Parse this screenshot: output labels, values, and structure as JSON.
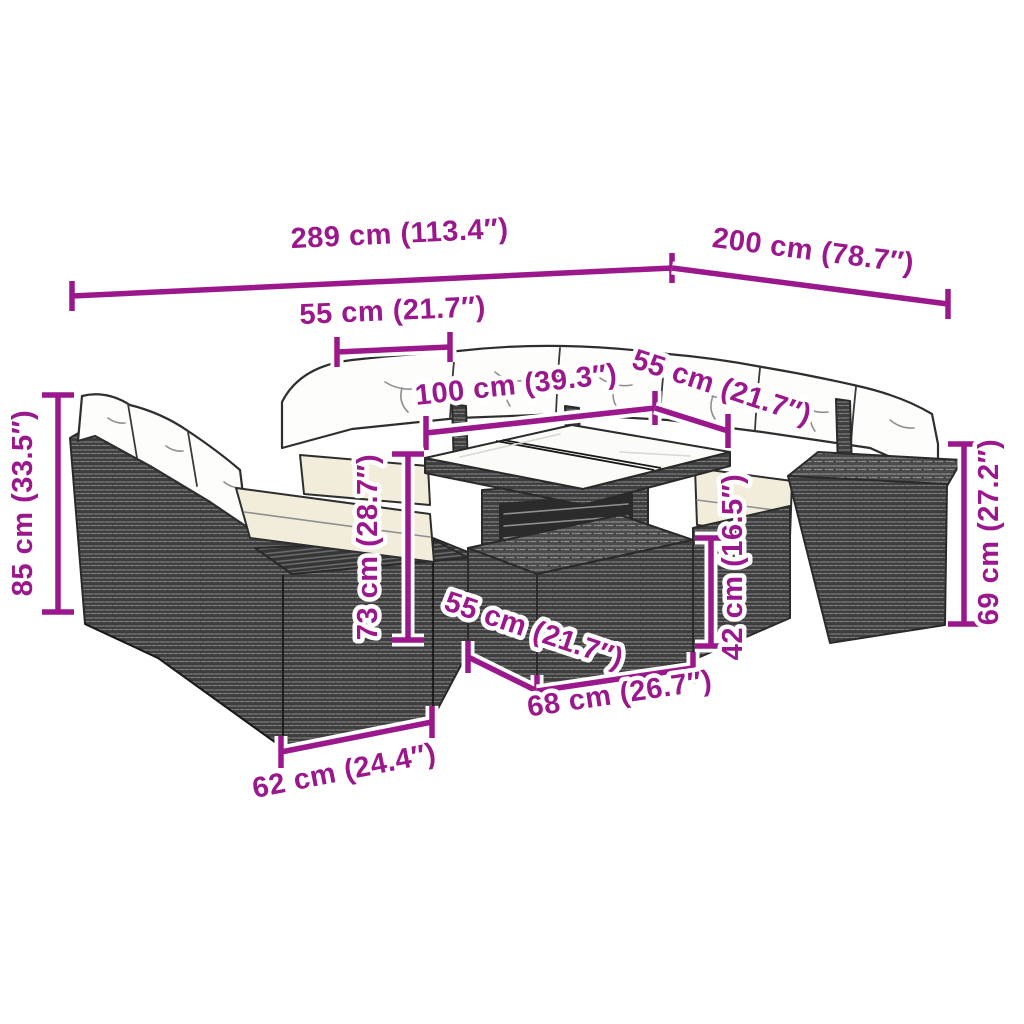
{
  "diagram": {
    "kind": "product-dimension-diagram",
    "subject": "rattan-garden-lounge-set-with-table-and-footstool"
  },
  "colors": {
    "dimension_accent": "#9A188C",
    "rattan_dark": "#3D3D3D",
    "rattan_weave_light": "#7A7A7A",
    "cushion_white": "#FDFDFB",
    "cushion_cream": "#F1EDDA",
    "outline": "#2A2A2A",
    "background": "#FFFFFF"
  },
  "dimensions": [
    {
      "name": "sofa-total-width",
      "label": "289 cm (113.4″)"
    },
    {
      "name": "sofa-total-depth",
      "label": "200 cm (78.7″)"
    },
    {
      "name": "seat-width-left",
      "label": "55 cm (21.7″)"
    },
    {
      "name": "table-top-length",
      "label": "100 cm (39.3″)"
    },
    {
      "name": "seat-width-right",
      "label": "55 cm (21.7″)"
    },
    {
      "name": "backrest-height",
      "label": "85 cm (33.5″)"
    },
    {
      "name": "table-height",
      "label": "73 cm (28.7″)"
    },
    {
      "name": "footstool-height",
      "label": "42 cm (16.5″)"
    },
    {
      "name": "armrest-height",
      "label": "69 cm (27.2″)"
    },
    {
      "name": "footstool-depth",
      "label": "55 cm (21.7″)"
    },
    {
      "name": "footstool-width",
      "label": "68 cm (26.7″)"
    },
    {
      "name": "seat-depth",
      "label": "62 cm (24.4″)"
    }
  ]
}
